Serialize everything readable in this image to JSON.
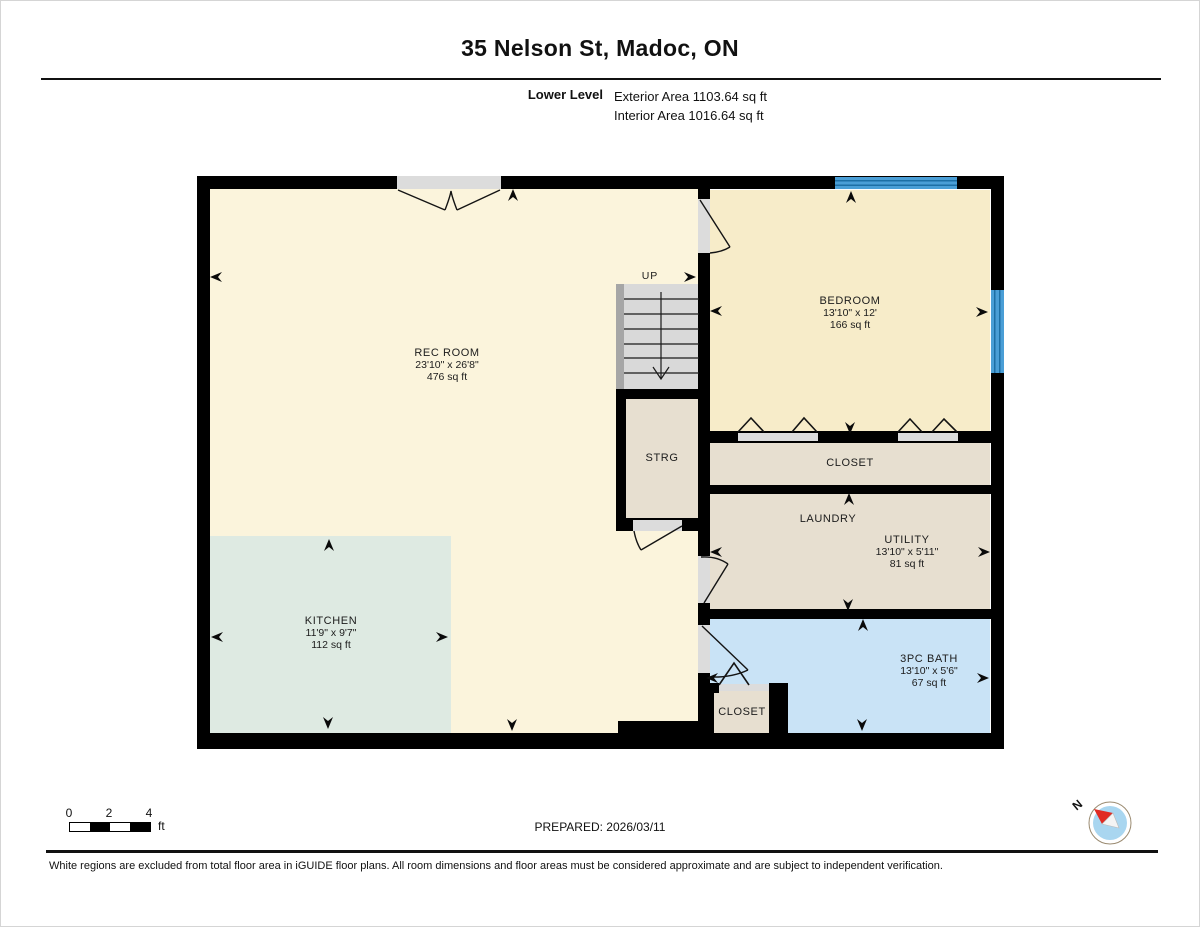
{
  "header": {
    "title": "35 Nelson St, Madoc, ON",
    "level_label": "Lower Level",
    "exterior_area": "Exterior Area 1103.64 sq ft",
    "interior_area": "Interior Area 1016.64 sq ft"
  },
  "rooms": {
    "rec_room": {
      "name": "REC ROOM",
      "dims": "23'10\" x 26'8\"",
      "area": "476 sq ft"
    },
    "kitchen": {
      "name": "KITCHEN",
      "dims": "11'9\" x 9'7\"",
      "area": "112 sq ft"
    },
    "bedroom": {
      "name": "BEDROOM",
      "dims": "13'10\" x 12'",
      "area": "166 sq ft"
    },
    "strg": {
      "name": "STRG"
    },
    "closet_upper": {
      "name": "CLOSET"
    },
    "laundry": {
      "name": "LAUNDRY"
    },
    "utility": {
      "name": "UTILITY",
      "dims": "13'10\" x 5'11\"",
      "area": "81 sq ft"
    },
    "bath": {
      "name": "3PC BATH",
      "dims": "13'10\" x 5'6\"",
      "area": "67 sq ft"
    },
    "closet_lower": {
      "name": "CLOSET"
    },
    "stairs": {
      "direction_label": "UP"
    }
  },
  "footer": {
    "prepared": "PREPARED: 2026/03/11",
    "scale_bar": {
      "tick_0": "0",
      "tick_2": "2",
      "tick_4": "4",
      "unit": "ft"
    },
    "compass": {
      "north_label": "N"
    },
    "disclaimer": "White regions are excluded from total floor area in iGUIDE floor plans. All room dimensions and floor areas must be considered approximate and are subject to independent verification."
  },
  "colors": {
    "wall": "#000000",
    "rec_room_fill": "#FBF4DC",
    "bedroom_fill": "#F7ECC9",
    "kitchen_fill": "#DEEAE2",
    "storage_fill": "#E7DFD0",
    "bath_fill": "#C9E3F6",
    "window_blue": "#4A9ED6",
    "stair_gray": "#D9D9D9",
    "door_gray": "#DCDCDC",
    "compass_needle_red": "#E02A22",
    "compass_circle_blue": "#A9D6F0"
  }
}
